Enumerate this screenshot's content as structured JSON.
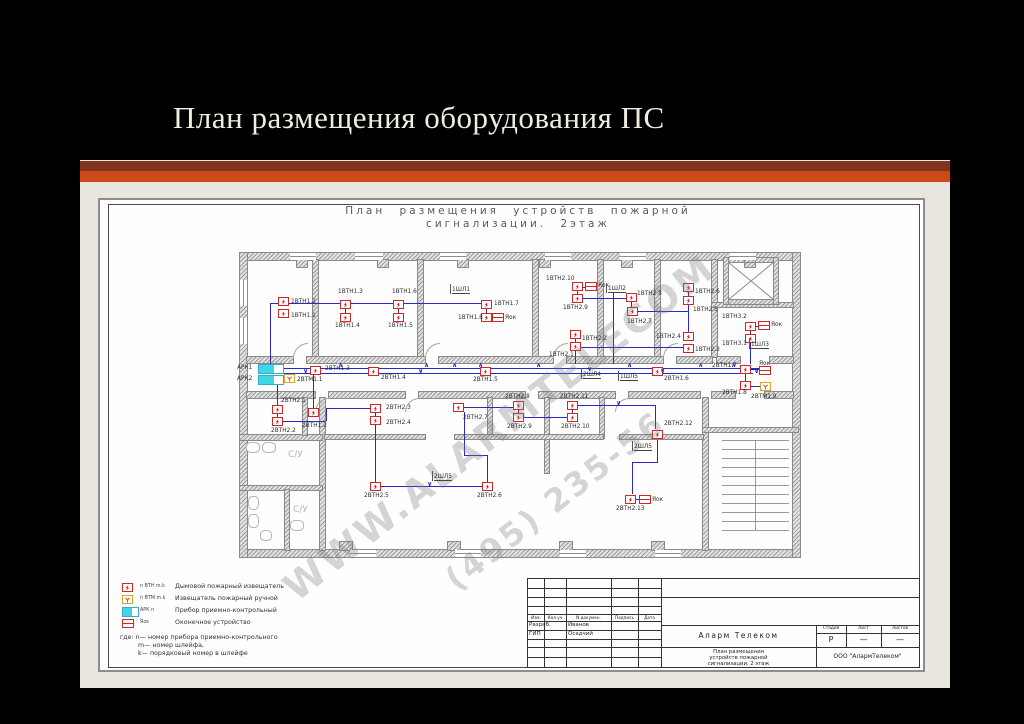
{
  "slide": {
    "title": "План размещения оборудования ПС"
  },
  "drawing": {
    "title_line1": "План размещения устройств пожарной",
    "title_line2": "сигнализации. 2этаж",
    "watermark_line1": "WWW.ALARMTELECOM",
    "watermark_line2": "(495) 235-56",
    "panel_labels": [
      "АРК1",
      "АРК2"
    ],
    "room_labels": [
      {
        "text": "С/У",
        "x": 288,
        "y": 450
      },
      {
        "text": "С/У",
        "x": 293,
        "y": 505
      }
    ],
    "detectors": [
      {
        "x": 283,
        "y": 301,
        "label": "1ВТН1.2",
        "lx": 291,
        "ly": 299
      },
      {
        "x": 283,
        "y": 313,
        "label": "1ВТН1.1",
        "lx": 291,
        "ly": 313
      },
      {
        "x": 345,
        "y": 304,
        "label": "1ВТН1.3",
        "lx": 338,
        "ly": 289
      },
      {
        "x": 345,
        "y": 317,
        "label": "1ВТН1.4",
        "lx": 335,
        "ly": 323
      },
      {
        "x": 398,
        "y": 304,
        "label": "1ВТН1.6",
        "lx": 392,
        "ly": 289
      },
      {
        "x": 398,
        "y": 317,
        "label": "1ВТН1.5",
        "lx": 388,
        "ly": 323
      },
      {
        "x": 486,
        "y": 304,
        "label": "1ВТН1.7",
        "lx": 494,
        "ly": 301
      },
      {
        "x": 486,
        "y": 317,
        "label": "1ВТН1.8",
        "lx": 458,
        "ly": 315
      },
      {
        "x": 577,
        "y": 286,
        "label": "1ВТН2.10",
        "lx": 546,
        "ly": 276
      },
      {
        "x": 577,
        "y": 298,
        "label": "1ВТН2.9",
        "lx": 563,
        "ly": 305
      },
      {
        "x": 631,
        "y": 297,
        "label": "1ВТН2.8",
        "lx": 637,
        "ly": 291
      },
      {
        "x": 632,
        "y": 311,
        "label": "1ВТН2.7",
        "lx": 627,
        "ly": 319
      },
      {
        "x": 688,
        "y": 287,
        "label": "1ВТН2.6",
        "lx": 695,
        "ly": 289
      },
      {
        "x": 688,
        "y": 300,
        "label": "1ВТН2.5",
        "lx": 693,
        "ly": 307
      },
      {
        "x": 688,
        "y": 336,
        "label": "1ВТН2.4",
        "lx": 656,
        "ly": 334
      },
      {
        "x": 688,
        "y": 348,
        "label": "1ВТН2.3",
        "lx": 695,
        "ly": 347
      },
      {
        "x": 575,
        "y": 334,
        "label": "1ВТН2.2",
        "lx": 582,
        "ly": 336
      },
      {
        "x": 575,
        "y": 346,
        "label": "1ВТН2.1",
        "lx": 549,
        "ly": 352
      },
      {
        "x": 750,
        "y": 326,
        "label": "1ВТН3.2",
        "lx": 722,
        "ly": 314
      },
      {
        "x": 750,
        "y": 338,
        "label": "1ВТН3.1",
        "lx": 722,
        "ly": 341
      },
      {
        "x": 315,
        "y": 370,
        "label": "2ВТН1.3",
        "lx": 325,
        "ly": 366
      },
      {
        "x": 373,
        "y": 371,
        "label": "2ВТН1.4",
        "lx": 381,
        "ly": 375
      },
      {
        "x": 485,
        "y": 371,
        "label": "2ВТН1.5",
        "lx": 473,
        "ly": 377
      },
      {
        "x": 657,
        "y": 371,
        "label": "2ВТН1.6",
        "lx": 664,
        "ly": 376
      },
      {
        "x": 745,
        "y": 369,
        "label": "2ВТН1.7",
        "lx": 712,
        "ly": 363
      },
      {
        "x": 745,
        "y": 385,
        "label": "2ВТН1.8",
        "lx": 722,
        "ly": 390
      },
      {
        "x": 277,
        "y": 409,
        "label": "2ВТН2.1",
        "lx": 281,
        "ly": 398
      },
      {
        "x": 277,
        "y": 421,
        "label": "2ВТН2.2",
        "lx": 271,
        "ly": 428
      },
      {
        "x": 313,
        "y": 412,
        "label": "2ВТН1.2",
        "lx": 302,
        "ly": 423
      },
      {
        "x": 375,
        "y": 408,
        "label": "2ВТН2.3",
        "lx": 386,
        "ly": 405
      },
      {
        "x": 375,
        "y": 420,
        "label": "2ВТН2.4",
        "lx": 386,
        "ly": 420
      },
      {
        "x": 375,
        "y": 486,
        "label": "2ВТН2.5",
        "lx": 364,
        "ly": 493
      },
      {
        "x": 487,
        "y": 486,
        "label": "2ВТН2.6",
        "lx": 477,
        "ly": 493
      },
      {
        "x": 458,
        "y": 407,
        "label": "2ВТН2.7",
        "lx": 463,
        "ly": 415
      },
      {
        "x": 518,
        "y": 405,
        "label": "2ВТН2.8",
        "lx": 505,
        "ly": 394
      },
      {
        "x": 518,
        "y": 417,
        "label": "2ВТН2.9",
        "lx": 507,
        "ly": 424
      },
      {
        "x": 572,
        "y": 405,
        "label": "2ВТН2.11",
        "lx": 560,
        "ly": 394
      },
      {
        "x": 572,
        "y": 417,
        "label": "2ВТН2.10",
        "lx": 561,
        "ly": 424
      },
      {
        "x": 657,
        "y": 434,
        "label": "2ВТН2.12",
        "lx": 664,
        "ly": 421
      },
      {
        "x": 630,
        "y": 499,
        "label": "2ВТН2.13",
        "lx": 616,
        "ly": 506
      }
    ],
    "manual_points": [
      {
        "x": 289,
        "y": 378,
        "label": "2ВТМ1.1",
        "lx": 297,
        "ly": 377
      },
      {
        "x": 765,
        "y": 386,
        "label": "2ВТМ1.9",
        "lx": 751,
        "ly": 394
      }
    ],
    "terminals": [
      {
        "x": 497,
        "y": 317,
        "label": "Яок",
        "lx": 505,
        "ly": 315
      },
      {
        "x": 590,
        "y": 286,
        "label": "Яок",
        "lx": 598,
        "ly": 283
      },
      {
        "x": 763,
        "y": 325,
        "label": "Яок",
        "lx": 771,
        "ly": 322
      },
      {
        "x": 764,
        "y": 370,
        "label": "Яок",
        "lx": 759,
        "ly": 361
      },
      {
        "x": 644,
        "y": 499,
        "label": "Яок",
        "lx": 652,
        "ly": 497
      }
    ],
    "flags": [
      {
        "x": 452,
        "y": 287,
        "label": "1ШЛ1"
      },
      {
        "x": 608,
        "y": 286,
        "label": "1ШЛ2"
      },
      {
        "x": 751,
        "y": 342,
        "label": "1ШЛ3"
      },
      {
        "x": 583,
        "y": 372,
        "label": "2ШЛ4"
      },
      {
        "x": 620,
        "y": 374,
        "label": "1ШЛ5"
      },
      {
        "x": 434,
        "y": 474,
        "label": "2ШЛ5"
      },
      {
        "x": 634,
        "y": 444,
        "label": "2ШЛ5"
      }
    ],
    "arrows": [
      {
        "x": 338,
        "y": 362,
        "d": "up"
      },
      {
        "x": 424,
        "y": 362,
        "d": "up"
      },
      {
        "x": 452,
        "y": 362,
        "d": "up"
      },
      {
        "x": 478,
        "y": 362,
        "d": "up"
      },
      {
        "x": 536,
        "y": 362,
        "d": "up"
      },
      {
        "x": 627,
        "y": 362,
        "d": "up"
      },
      {
        "x": 698,
        "y": 362,
        "d": "up"
      },
      {
        "x": 731,
        "y": 362,
        "d": "up"
      },
      {
        "x": 303,
        "y": 368,
        "d": "down"
      },
      {
        "x": 418,
        "y": 368,
        "d": "down"
      },
      {
        "x": 587,
        "y": 366,
        "d": "down"
      },
      {
        "x": 660,
        "y": 368,
        "d": "down"
      },
      {
        "x": 754,
        "y": 368,
        "d": "down"
      },
      {
        "x": 427,
        "y": 481,
        "d": "down"
      },
      {
        "x": 616,
        "y": 400,
        "d": "down"
      }
    ]
  },
  "legend": {
    "rows": [
      {
        "code": "n ВТН m.k",
        "desc": "Дымовой пожарный извещатель"
      },
      {
        "code": "n ВТМ m.k",
        "desc": "Извещатель пожарный ручной"
      },
      {
        "code": "АРК n",
        "desc": "Прибор приемно-контрольный"
      },
      {
        "code": "Яок",
        "desc": "Оконечное устройство"
      }
    ],
    "notes": [
      "где: n— номер прибора приемно-контрольного",
      "m— номер шлейфа,",
      "k— порядковый номер в шлейфе"
    ]
  },
  "titleblock": {
    "header_cols": [
      "Изм.",
      "Кол.уч",
      "N докумен.",
      "Подпись",
      "Дата"
    ],
    "row1_role": "Разраб.",
    "row1_name": "Иванов",
    "row2_role": "ГИП",
    "row2_name": "Осадчий",
    "company": "Аларм Телеком",
    "stage_label": "Стадия",
    "sheet_label": "Лист",
    "sheets_label": "Листов",
    "stage_value": "Р",
    "sheet_value": "—",
    "sheets_value": "—",
    "doc_title_line1": "План размещения",
    "doc_title_line2": "устройств пожарной",
    "doc_title_line3": "сигнализации. 2 этаж",
    "org": "ООО \"АлармТелеком\""
  }
}
